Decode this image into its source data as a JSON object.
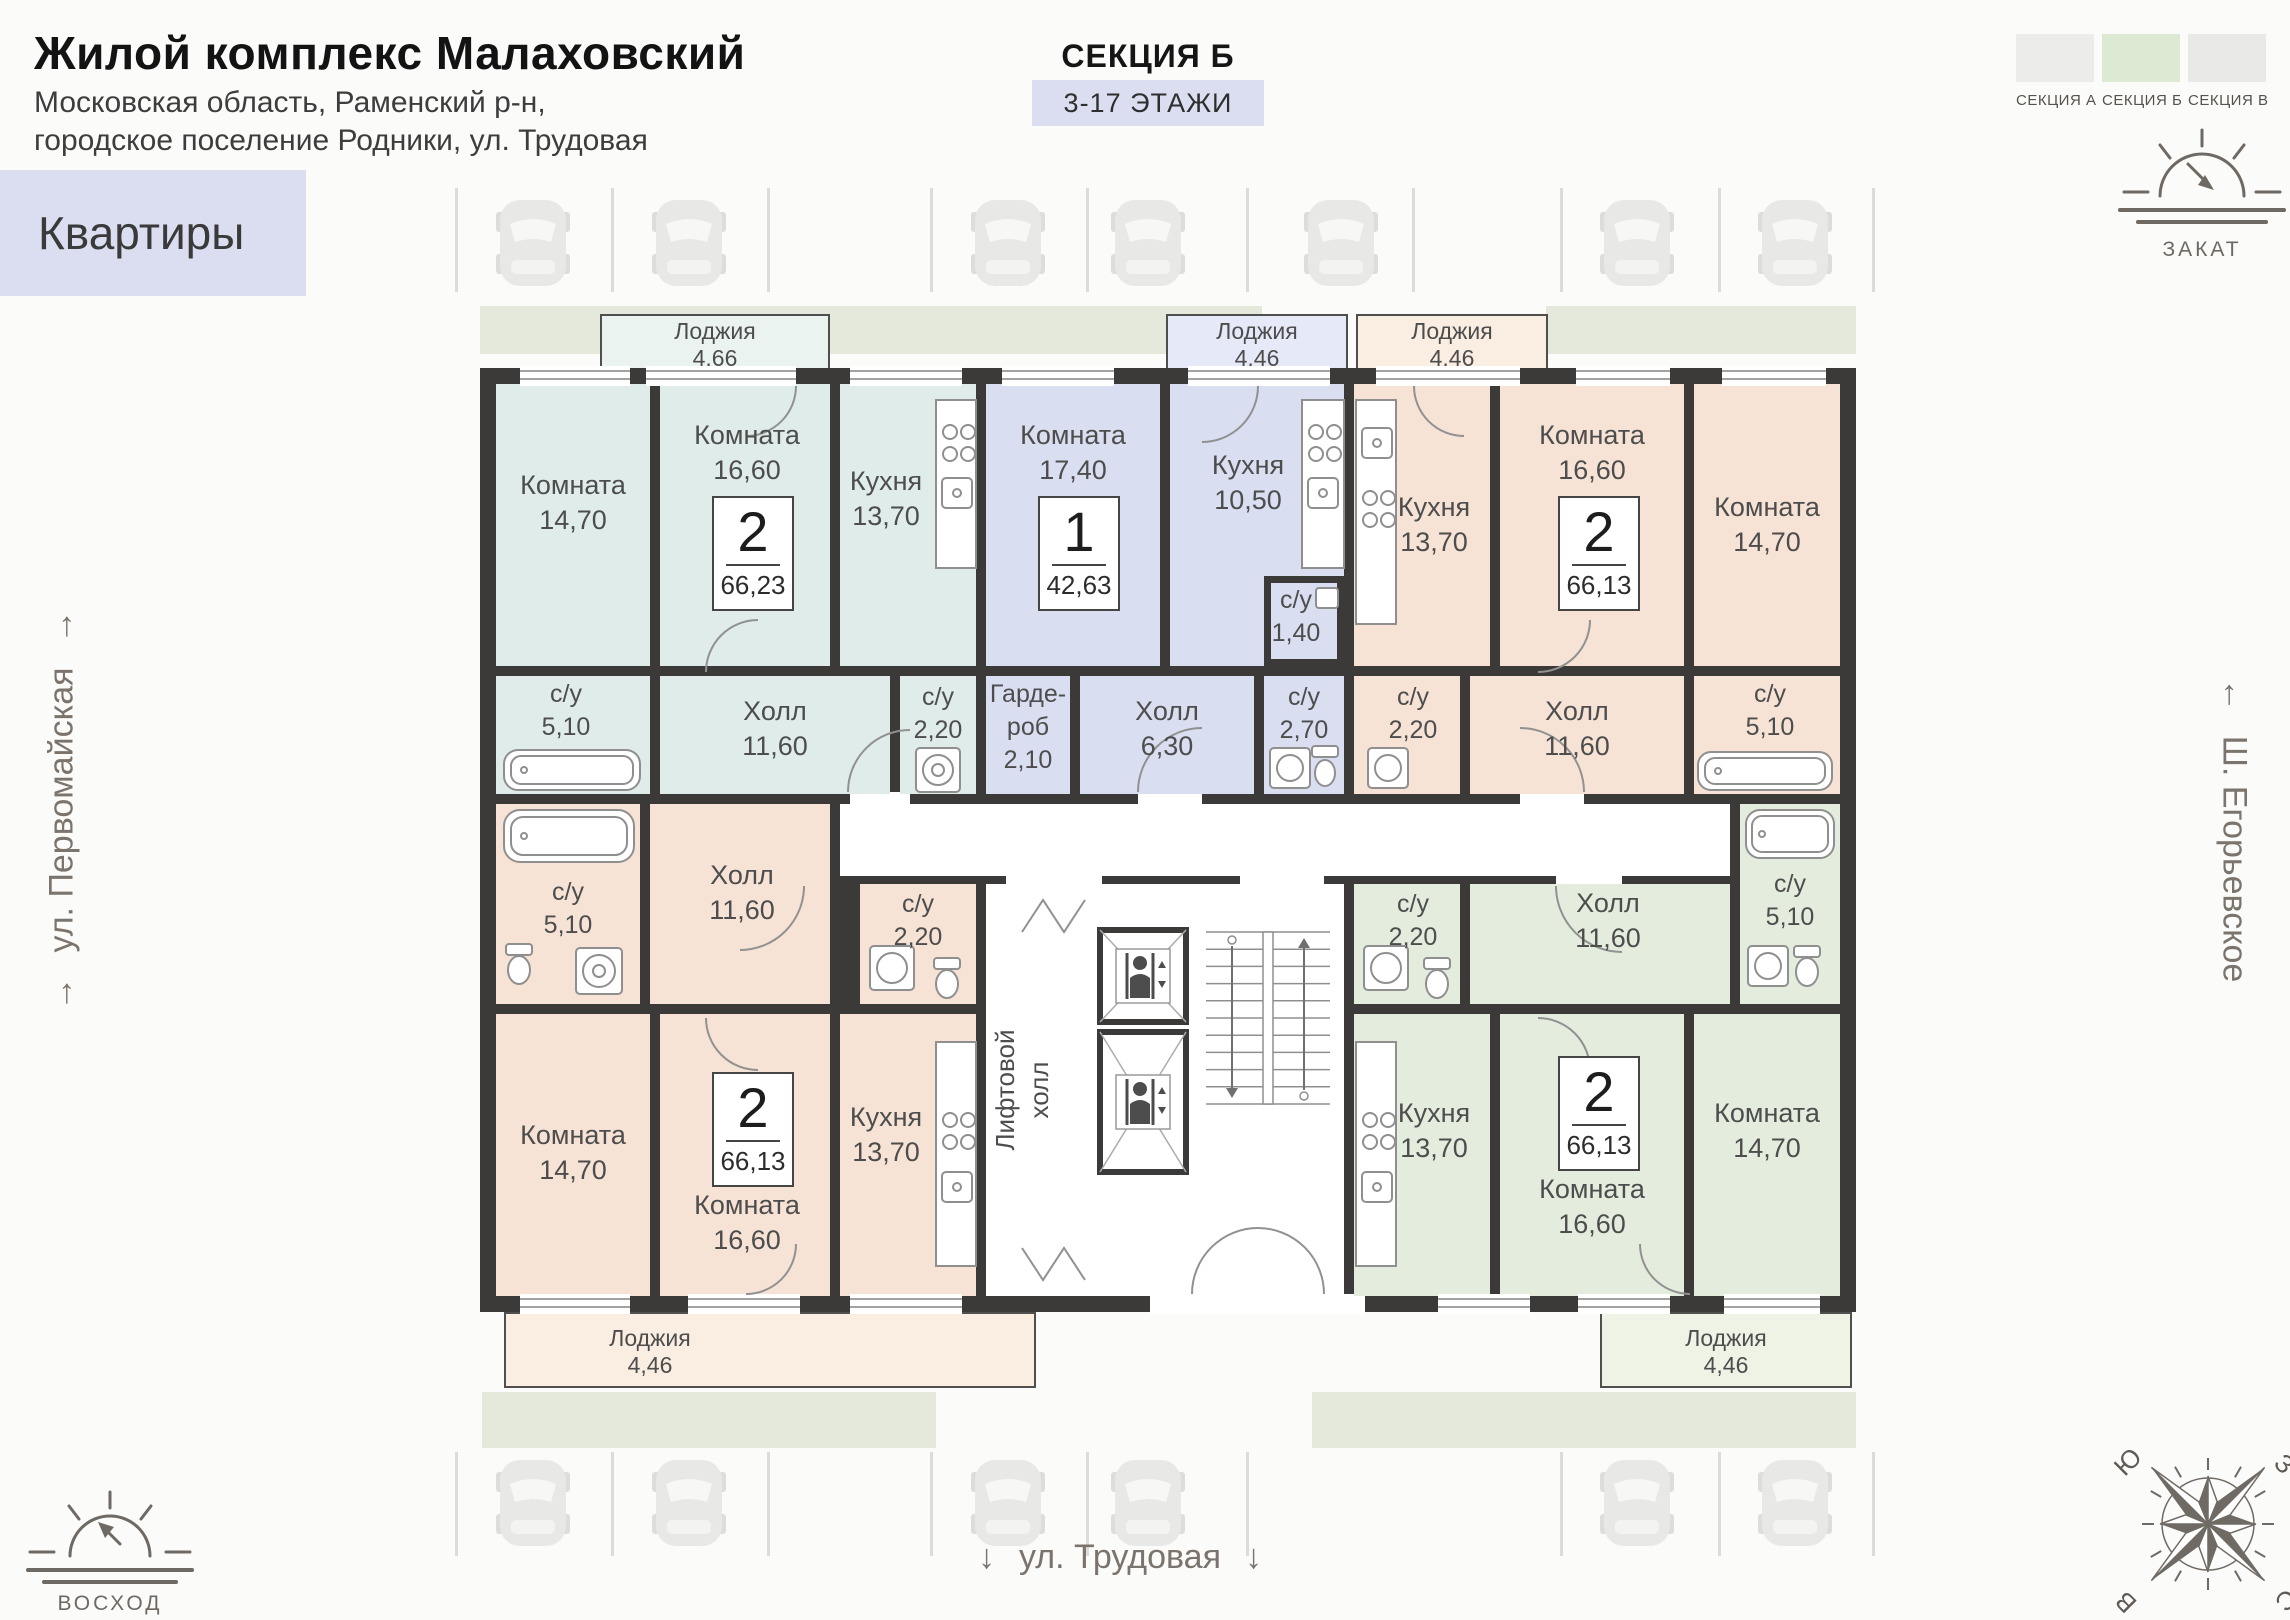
{
  "header": {
    "title": "Жилой комплекс Малаховский",
    "address_line1": "Московская область, Раменский р-н,",
    "address_line2": "городское поселение Родники, ул. Трудовая",
    "apartments_label": "Квартиры"
  },
  "section": {
    "title": "СЕКЦИЯ Б",
    "floors": "3-17 ЭТАЖИ"
  },
  "section_picker": [
    {
      "label": "СЕКЦИЯ А",
      "color": "#ececeb",
      "active": false
    },
    {
      "label": "СЕКЦИЯ Б",
      "color": "#dcead3",
      "active": true
    },
    {
      "label": "СЕКЦИЯ В",
      "color": "#e9e9e8",
      "active": false
    }
  ],
  "orientation": {
    "sunset": "ЗАКАТ",
    "sunrise": "ВОСХОД",
    "street_left": "ул. Первомайская",
    "street_right": "Ш. Егорьевское",
    "street_bottom": "ул. Трудовая",
    "compass": {
      "north": "С",
      "south": "Ю",
      "west": "З",
      "east": "В"
    }
  },
  "plan": {
    "wall_color": "#3b3a38",
    "elevator_hall": {
      "line1": "Лифтовой",
      "line2": "холл"
    },
    "apartments": [
      {
        "id": "top-left",
        "color": "#dfecea",
        "loggia": {
          "name": "Лоджия",
          "area": "4,66",
          "x": 600,
          "y": 314,
          "w": 230,
          "h": 58,
          "color": "#ebf3f1"
        },
        "badge": {
          "rooms": "2",
          "area": "66,23",
          "x": 712,
          "y": 496
        },
        "rooms": [
          {
            "name": "Комната",
            "area": "14,70",
            "x": 496,
            "y": 384,
            "w": 154,
            "h": 282,
            "lx": 573,
            "ly": 468
          },
          {
            "name": "Комната",
            "area": "16,60",
            "x": 660,
            "y": 384,
            "w": 170,
            "h": 282,
            "lx": 747,
            "ly": 418
          },
          {
            "name": "Кухня",
            "area": "13,70",
            "x": 840,
            "y": 384,
            "w": 136,
            "h": 282,
            "lx": 886,
            "ly": 464
          },
          {
            "name": "Холл",
            "area": "11,60",
            "x": 660,
            "y": 676,
            "w": 230,
            "h": 118,
            "lx": 775,
            "ly": 694
          },
          {
            "name": "с/у",
            "area": "2,20",
            "x": 900,
            "y": 676,
            "w": 76,
            "h": 118,
            "lx": 938,
            "ly": 681,
            "small": true
          },
          {
            "name": "с/у",
            "area": "5,10",
            "x": 496,
            "y": 676,
            "w": 154,
            "h": 118,
            "lx": 566,
            "ly": 678,
            "small": true
          }
        ]
      },
      {
        "id": "top-middle",
        "color": "#dadef1",
        "loggia": {
          "name": "Лоджия",
          "area": "4,46",
          "x": 1166,
          "y": 314,
          "w": 182,
          "h": 58,
          "color": "#e6e9f7"
        },
        "badge": {
          "rooms": "1",
          "area": "42,63",
          "x": 1038,
          "y": 496
        },
        "rooms": [
          {
            "name": "Комната",
            "area": "17,40",
            "x": 986,
            "y": 384,
            "w": 174,
            "h": 282,
            "lx": 1073,
            "ly": 418
          },
          {
            "name": "Кухня",
            "area": "10,50",
            "x": 1170,
            "y": 384,
            "w": 174,
            "h": 282,
            "lx": 1248,
            "ly": 448
          },
          {
            "name": "Гардероб",
            "area": "2,10",
            "lines": [
              "Гарде-",
              "роб",
              "2,10"
            ],
            "x": 986,
            "y": 676,
            "w": 84,
            "h": 118,
            "lx": 1028,
            "ly": 678,
            "small": true
          },
          {
            "name": "Холл",
            "area": "6,30",
            "x": 1080,
            "y": 676,
            "w": 174,
            "h": 118,
            "lx": 1167,
            "ly": 694
          },
          {
            "name": "с/у",
            "area": "1,40",
            "x": 1264,
            "y": 576,
            "w": 80,
            "h": 90,
            "lx": 1296,
            "ly": 584,
            "small": true,
            "inset": true
          },
          {
            "name": "с/у",
            "area": "2,70",
            "x": 1264,
            "y": 676,
            "w": 80,
            "h": 118,
            "lx": 1304,
            "ly": 681,
            "small": true
          }
        ]
      },
      {
        "id": "top-right",
        "color": "#f6e3d5",
        "loggia": {
          "name": "Лоджия",
          "area": "4,46",
          "x": 1356,
          "y": 314,
          "w": 192,
          "h": 58,
          "color": "#faeee3"
        },
        "badge": {
          "rooms": "2",
          "area": "66,13",
          "x": 1558,
          "y": 496
        },
        "rooms": [
          {
            "name": "Кухня",
            "area": "13,70",
            "x": 1354,
            "y": 384,
            "w": 136,
            "h": 282,
            "lx": 1434,
            "ly": 490
          },
          {
            "name": "Комната",
            "area": "16,60",
            "x": 1500,
            "y": 384,
            "w": 184,
            "h": 282,
            "lx": 1592,
            "ly": 418
          },
          {
            "name": "Комната",
            "area": "14,70",
            "x": 1694,
            "y": 384,
            "w": 146,
            "h": 282,
            "lx": 1767,
            "ly": 490
          },
          {
            "name": "с/у",
            "area": "2,20",
            "x": 1354,
            "y": 676,
            "w": 106,
            "h": 118,
            "lx": 1413,
            "ly": 681,
            "small": true
          },
          {
            "name": "Холл",
            "area": "11,60",
            "x": 1470,
            "y": 676,
            "w": 214,
            "h": 118,
            "lx": 1577,
            "ly": 694
          },
          {
            "name": "с/у",
            "area": "5,10",
            "x": 1694,
            "y": 676,
            "w": 146,
            "h": 118,
            "lx": 1770,
            "ly": 678,
            "small": true
          }
        ]
      },
      {
        "id": "bottom-left",
        "color": "#f6e3d5",
        "loggia": {
          "name": "Лоджия",
          "area": "4,46",
          "x": 504,
          "y": 1312,
          "w": 532,
          "h": 76,
          "color": "#faeee3",
          "label_dx": -120
        },
        "badge": {
          "rooms": "2",
          "area": "66,13",
          "x": 712,
          "y": 1072
        },
        "rooms": [
          {
            "name": "с/у",
            "area": "5,10",
            "x": 496,
            "y": 804,
            "w": 144,
            "h": 200,
            "lx": 568,
            "ly": 876,
            "small": true
          },
          {
            "name": "Холл",
            "area": "11,60",
            "x": 650,
            "y": 804,
            "w": 180,
            "h": 200,
            "lx": 742,
            "ly": 858
          },
          {
            "name": "с/у",
            "area": "2,20",
            "x": 860,
            "y": 884,
            "w": 116,
            "h": 120,
            "lx": 918,
            "ly": 888,
            "small": true
          },
          {
            "name": "Комната",
            "area": "14,70",
            "x": 496,
            "y": 1014,
            "w": 154,
            "h": 282,
            "lx": 573,
            "ly": 1118
          },
          {
            "name": "Комната",
            "area": "16,60",
            "x": 660,
            "y": 1014,
            "w": 170,
            "h": 282,
            "lx": 747,
            "ly": 1188
          },
          {
            "name": "Кухня",
            "area": "13,70",
            "x": 840,
            "y": 1014,
            "w": 136,
            "h": 282,
            "lx": 886,
            "ly": 1100
          }
        ]
      },
      {
        "id": "bottom-right",
        "color": "#e4eddd",
        "loggia": {
          "name": "Лоджия",
          "area": "4,46",
          "x": 1600,
          "y": 1312,
          "w": 252,
          "h": 76,
          "color": "#eef3e6"
        },
        "badge": {
          "rooms": "2",
          "area": "66,13",
          "x": 1558,
          "y": 1056
        },
        "rooms": [
          {
            "name": "с/у",
            "area": "2,20",
            "x": 1354,
            "y": 884,
            "w": 106,
            "h": 120,
            "lx": 1413,
            "ly": 888,
            "small": true
          },
          {
            "name": "Холл",
            "area": "11,60",
            "x": 1470,
            "y": 884,
            "w": 260,
            "h": 120,
            "lx": 1608,
            "ly": 886
          },
          {
            "name": "с/у",
            "area": "5,10",
            "x": 1740,
            "y": 804,
            "w": 100,
            "h": 200,
            "lx": 1790,
            "ly": 868,
            "small": true
          },
          {
            "name": "Кухня",
            "area": "13,70",
            "x": 1354,
            "y": 1014,
            "w": 136,
            "h": 282,
            "lx": 1434,
            "ly": 1096
          },
          {
            "name": "Комната",
            "area": "16,60",
            "x": 1500,
            "y": 1014,
            "w": 184,
            "h": 282,
            "lx": 1592,
            "ly": 1172
          },
          {
            "name": "Комната",
            "area": "14,70",
            "x": 1694,
            "y": 1014,
            "w": 146,
            "h": 282,
            "lx": 1767,
            "ly": 1096
          }
        ]
      }
    ]
  }
}
